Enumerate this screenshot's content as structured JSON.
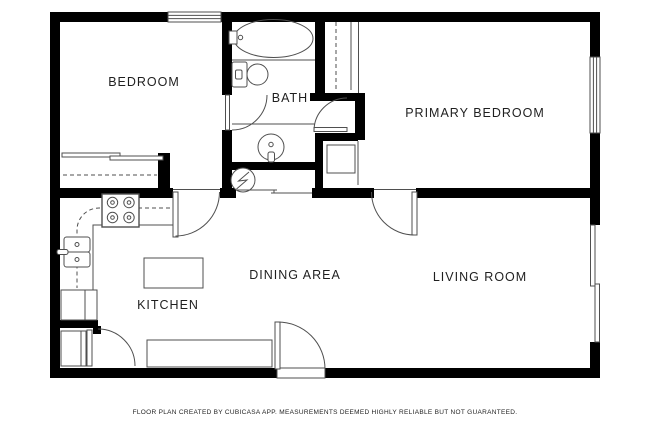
{
  "plan": {
    "type": "floor-plan",
    "source_app": "CubiCasa"
  },
  "rooms": [
    {
      "label": "BEDROOM"
    },
    {
      "label": "BATH"
    },
    {
      "label": "PRIMARY BEDROOM"
    },
    {
      "label": "KITCHEN"
    },
    {
      "label": "DINING AREA"
    },
    {
      "label": "LIVING ROOM"
    }
  ],
  "fixtures": [
    "bathtub",
    "toilet",
    "bathroom-sink",
    "water-heater",
    "stove-cooktop",
    "kitchen-sink",
    "kitchen-island",
    "kitchen-counter",
    "dining-side-cabinet",
    "bedroom-closet",
    "primary-bedroom-closet",
    "linen-closet",
    "entry-door",
    "interior-door",
    "window",
    "sliding-glass-door"
  ],
  "footer": {
    "text": "FLOOR PLAN CREATED BY CUBICASA APP. MEASUREMENTS DEEMED HIGHLY RELIABLE BUT NOT GUARANTEED."
  },
  "colors": {
    "wall": "#000000",
    "line": "#4f4f4f",
    "text": "#1f1f1f",
    "background": "#ffffff"
  }
}
